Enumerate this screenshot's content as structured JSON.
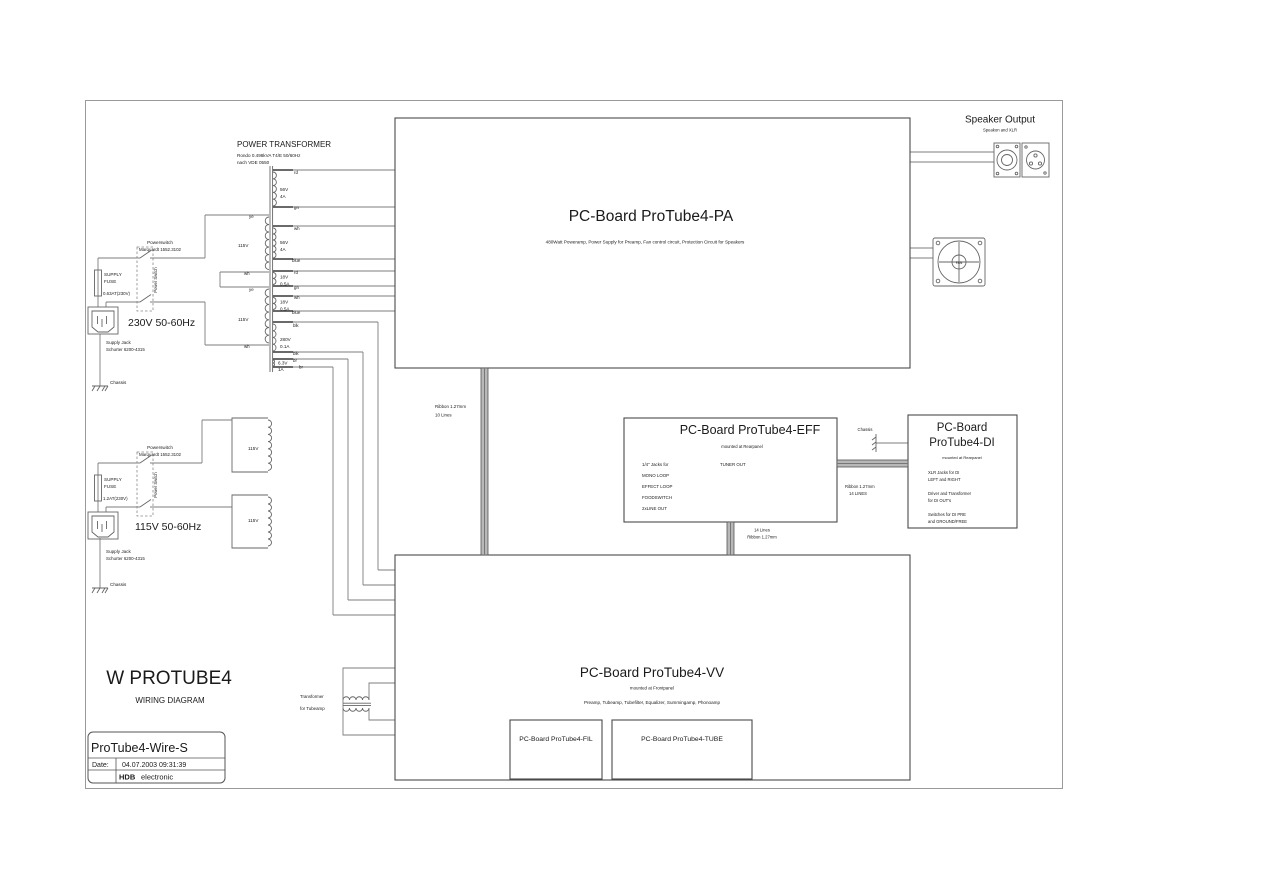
{
  "transformer": {
    "title": "POWER TRANSFORMER",
    "spec1": "Rondo 0.498kVA T4/E 50/60Hz",
    "spec2": "nach VDE 0550",
    "primaries": [
      {
        "voltage": "115V",
        "top_color": "ye",
        "bottom_color": "wh"
      },
      {
        "voltage": "115V",
        "top_color": "ye",
        "bottom_color": "wh"
      }
    ],
    "secondaries": [
      {
        "voltage": "56V",
        "current": "4A",
        "top_color": "rd",
        "bottom_color": "gn"
      },
      {
        "voltage": "56V",
        "current": "4A",
        "top_color": "wh",
        "bottom_color": "blue"
      },
      {
        "voltage": "18V",
        "current": "0.5A",
        "top_color": "rd",
        "bottom_color": "gn"
      },
      {
        "voltage": "18V",
        "current": "0.5A",
        "top_color": "wh",
        "bottom_color": "blue"
      },
      {
        "voltage": "280V",
        "current": "0.1A",
        "top_color": "blk",
        "bottom_color": "blk"
      },
      {
        "voltage": "6.3V",
        "current": "1A",
        "top_color": "br",
        "bottom_color": "br"
      }
    ]
  },
  "mains_230": {
    "switch_l1": "Powerswitch",
    "switch_l2": "Marquardt 1552.3102",
    "switch_vert": "Power Switch",
    "fuse_l1": "SUPPLY",
    "fuse_l2": "FUSE",
    "fuse_rating": "0.63AT(230V)",
    "voltage": "230V 50-60Hz",
    "jack_l1": "Supply Jack",
    "jack_l2": "Schurter 6200-4315",
    "chassis": "Chassis"
  },
  "mains_115": {
    "switch_l1": "Powerswitch",
    "switch_l2": "Marquardt 1552.3102",
    "switch_vert": "Power Switch",
    "fuse_l1": "SUPPLY",
    "fuse_l2": "FUSE",
    "fuse_rating": "1.2AT(230V)",
    "voltage": "115V 50-60Hz",
    "jack_l1": "Supply Jack",
    "jack_l2": "Schurter 6200-4315",
    "chassis": "Chassis",
    "winding_labels": [
      "115V",
      "115V"
    ]
  },
  "boards": {
    "pa": {
      "title": "PC-Board ProTube4-PA",
      "subtitle": "480Watt Poweramp, Power Supply for Preamp, Fan control circuit, Protection Circuit for Speakers"
    },
    "eff": {
      "title": "PC-Board  ProTube4-EFF",
      "mounted": "mounted at Rearpanel",
      "jacks_intro": "1/4\" Jacks for",
      "items": [
        "MONO LOOP",
        "EFFECT LOOP",
        "FOODSWITCH",
        "2xLINE OUT"
      ],
      "tuner": "TUNER OUT"
    },
    "di": {
      "title_line1": "PC-Board",
      "title_line2": "ProTube4-DI",
      "mounted": "mounted at Rearpanel",
      "lines": [
        "XLR Jacks for DI",
        "LEFT and RIGHT",
        "Driver and Transformer",
        "for DI OUT's",
        "Switches for DI PRE",
        "and GROUND/FREE"
      ]
    },
    "vv": {
      "title": "PC-Board ProTube4-VV",
      "mounted": "mounted at Frontpanel",
      "subtitle": "Preamp, Tubeamp, Tubefilter, Equalizer, Summingamp, Phonoamp",
      "fil": "PC-Board ProTube4-FIL",
      "tube": "PC-Board ProTube4-TUBE"
    }
  },
  "speaker_output": {
    "title": "Speaker Output",
    "subtitle": "Speakon and XLR"
  },
  "fan_label": "FAN",
  "ribbons": {
    "pa_vv_l1": "Ribbon 1.27mm",
    "pa_vv_l2": "10 Lines",
    "eff_vv_l1": "14 Lines",
    "eff_vv_l2": "Ribbon 1.27mm",
    "eff_di_l1": "Ribbon 1.27mm",
    "eff_di_l2": "14 LINES"
  },
  "chassis_di": "Chassis",
  "tube_transformer": {
    "l1": "Transformer",
    "l2": "for Tubeamp"
  },
  "titleblock": {
    "project": "W PROTUBE4",
    "doc_type": "WIRING DIAGRAM",
    "drawing": "ProTube4-Wire-S",
    "date_label": "Date:",
    "date_value": "04.07.2003 09:31:39",
    "company_bold": "HDB",
    "company_rest": "electronic"
  }
}
